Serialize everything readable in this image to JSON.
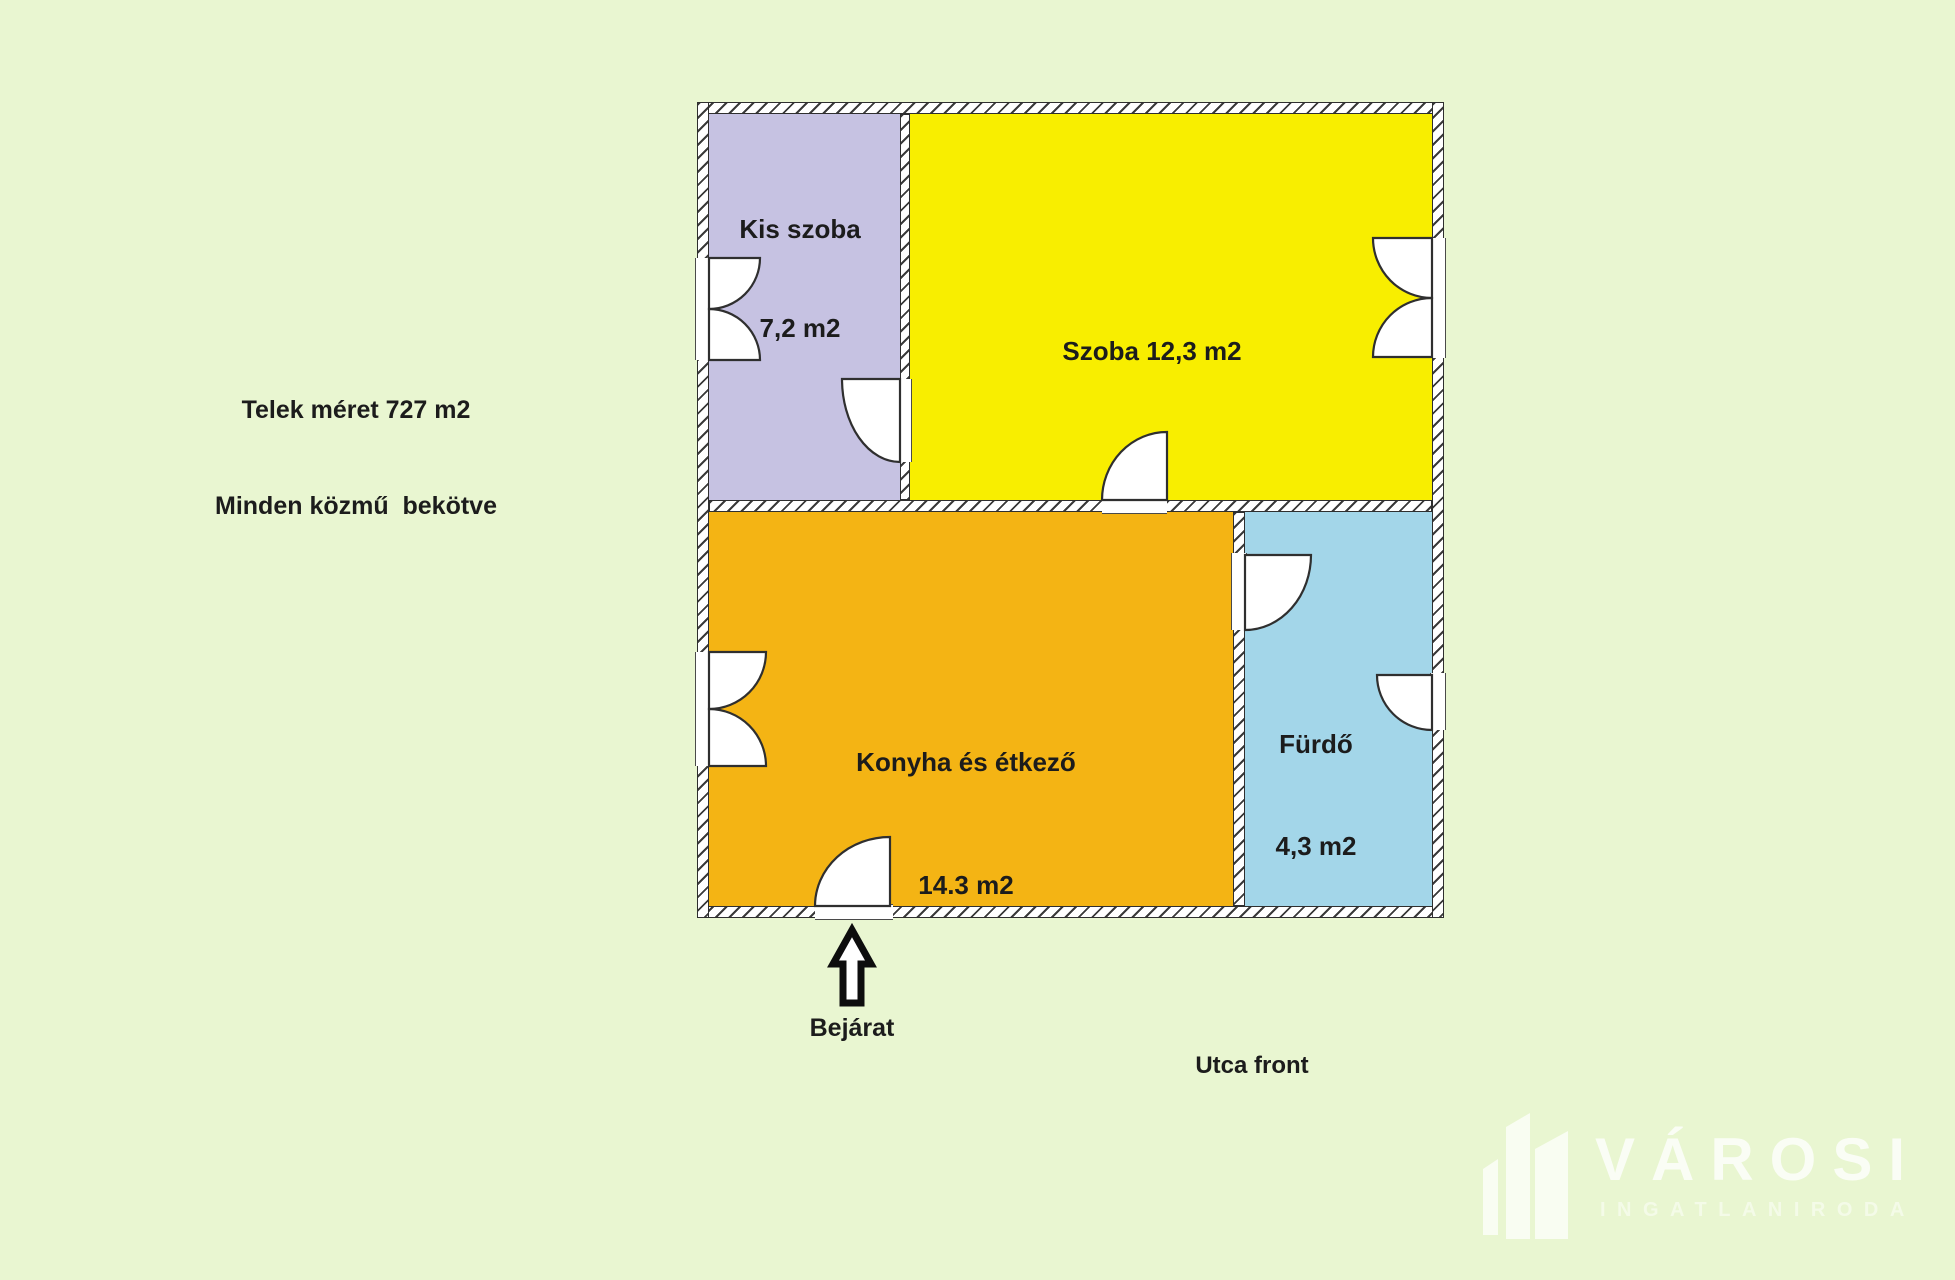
{
  "canvas": {
    "width": 1955,
    "height": 1280
  },
  "colors": {
    "background": "#e9f6d1",
    "wall_fill": "#ffffff",
    "wall_line": "#2f2f2f",
    "kis_szoba": "#c6c2e2",
    "szoba": "#f8ee00",
    "konyha": "#f4b414",
    "furdo": "#a3d6e9",
    "text": "#1c1c1c",
    "watermark": "#ffffff"
  },
  "site_info": {
    "line1": "Telek méret 727 m2",
    "line2": "Minden közmű  bekötve"
  },
  "floor_plan": {
    "rooms": [
      {
        "key": "kis_szoba",
        "name": "Kis szoba",
        "area": "7,2 m2"
      },
      {
        "key": "szoba",
        "name": "Szoba",
        "area": "12,3 m2",
        "label": "Szoba 12,3 m2"
      },
      {
        "key": "konyha",
        "name": "Konyha és étkező",
        "area": "14.3 m2"
      },
      {
        "key": "furdo",
        "name": "Fürdő",
        "area": "4,3 m2"
      }
    ]
  },
  "entrance": {
    "label": "Bejárat",
    "icon": "up-arrow"
  },
  "street": {
    "label": "Utca front"
  },
  "watermark": {
    "brand": "VÁROSI",
    "subtitle": "INGATLANIRODA",
    "icon": "buildings"
  }
}
